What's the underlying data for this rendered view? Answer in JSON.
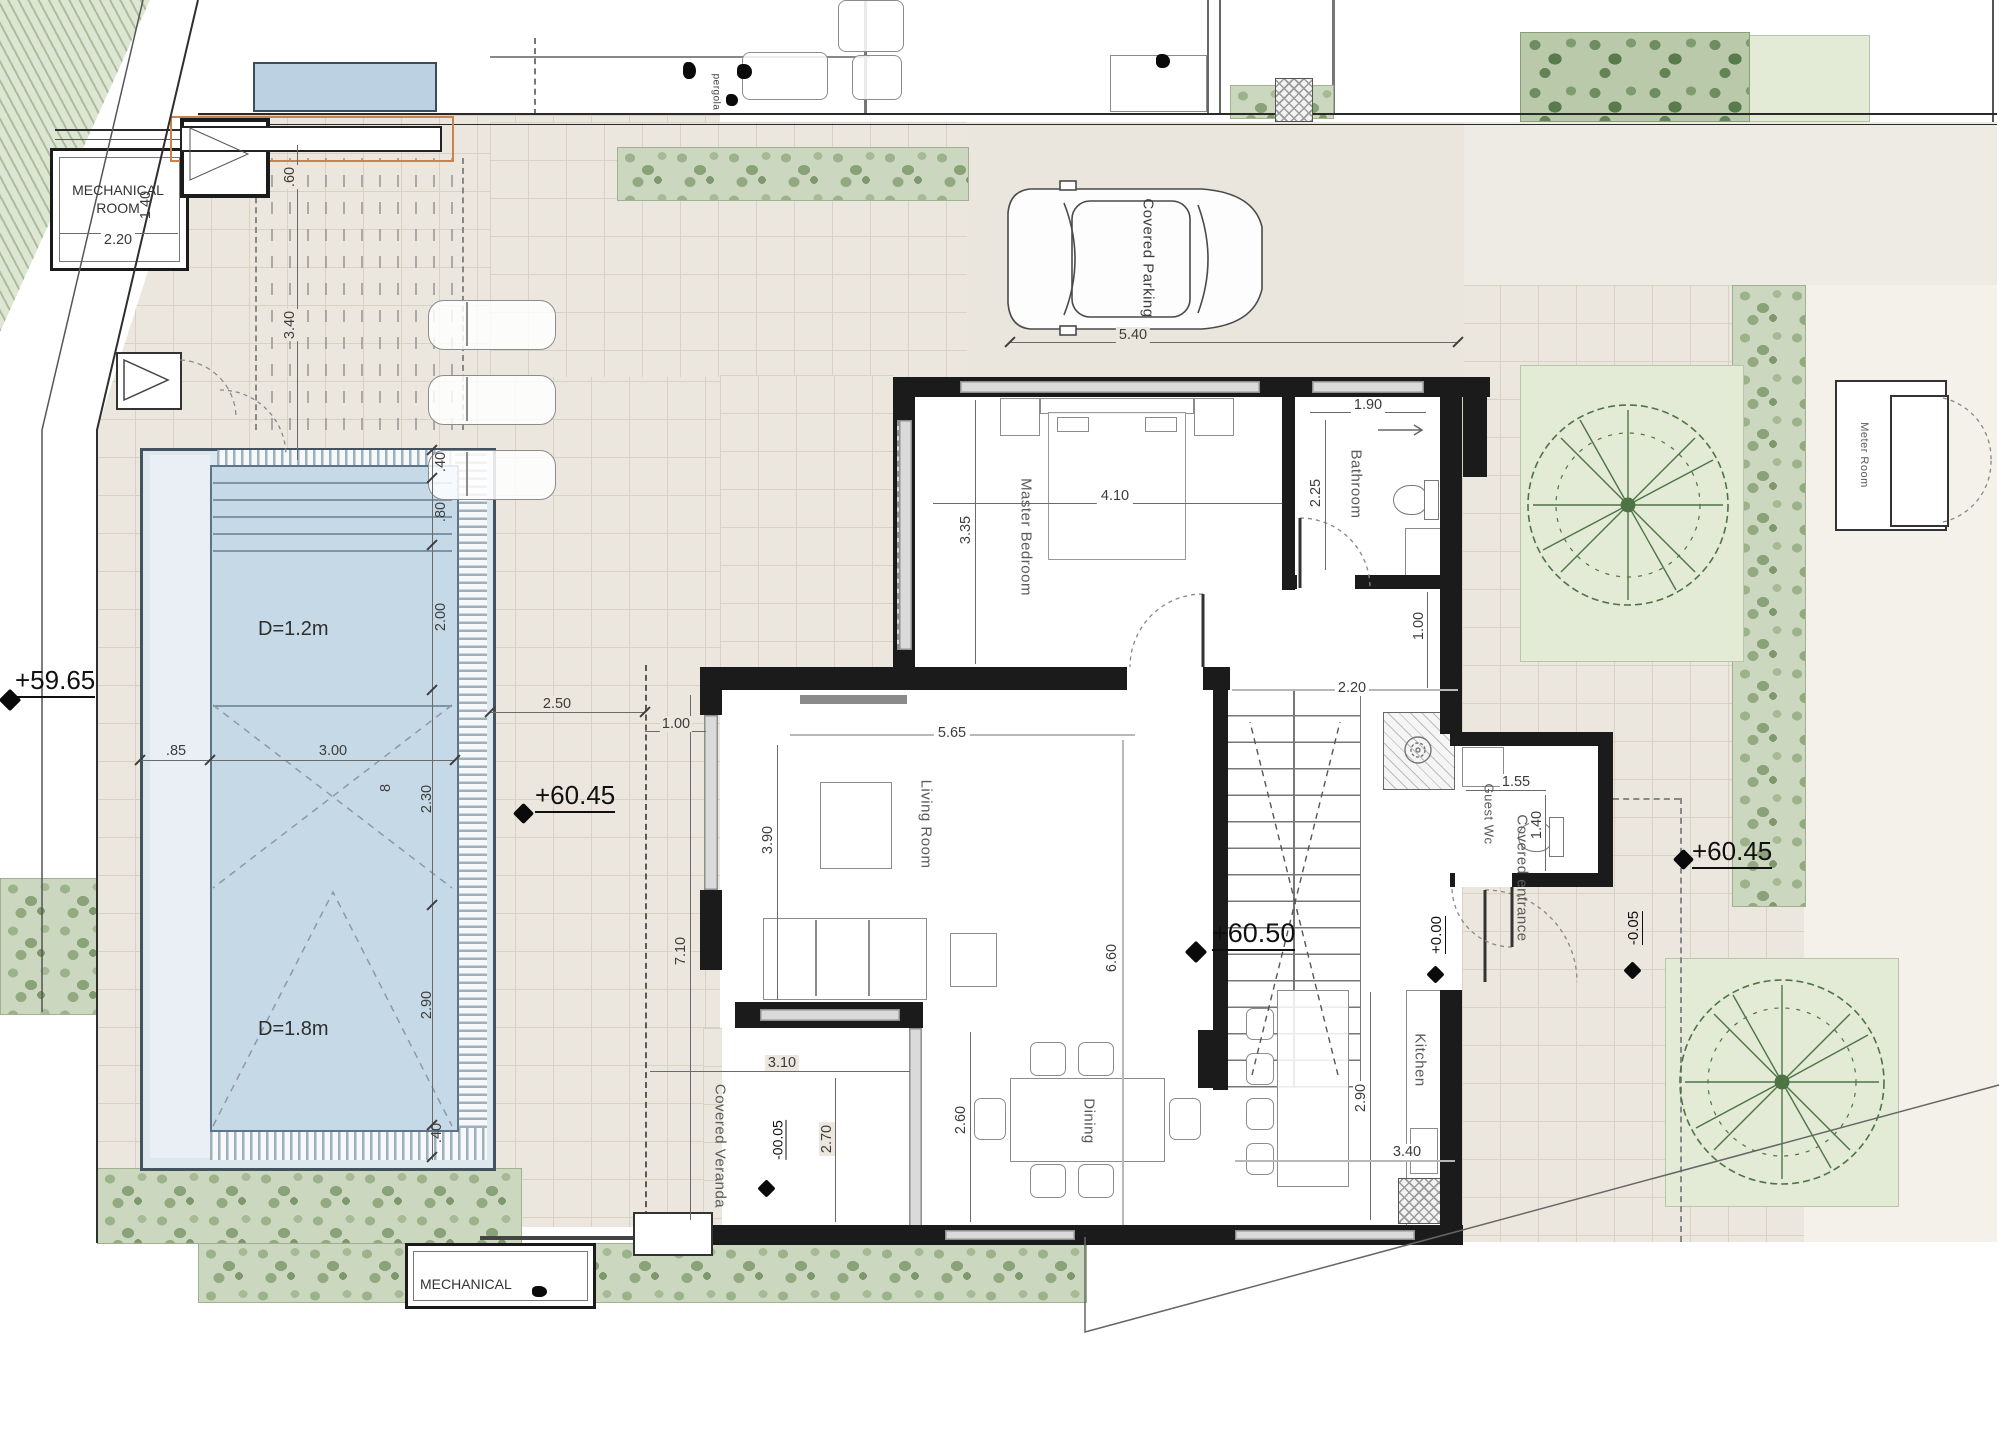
{
  "labels": {
    "mechanical_room": "MECHANICAL ROOM",
    "mechanical": "MECHANICAL",
    "master_bedroom": "Master Bedroom",
    "bathroom": "Bathroom",
    "living_room": "Living Room",
    "guest_wc": "Guest Wc",
    "kitchen": "Kitchen",
    "dining": "Dining",
    "covered_veranda": "Covered Veranda",
    "covered_entrance": "Covered entrance",
    "covered_parking": "Covered Parking",
    "meter_room": "Meter Room",
    "pergola": "pergola",
    "pool_depth_shallow": "D=1.2m",
    "pool_depth_deep": "D=1.8m"
  },
  "levels": {
    "road": "+59.65",
    "terrace_west": "+60.45",
    "interior": "+60.50",
    "terrace_east": "+60.45",
    "entry_zero": "+0.00",
    "entrance_minus": "-0.05",
    "veranda_minus": "-00.05"
  },
  "dims": {
    "mech_width": "2.20",
    "mech_height": "1.40",
    "planter_width": ".60",
    "pergola_length": "3.40",
    "pool_edge_top": ".40",
    "pool_steps": ".80",
    "pool_zone_shallow": "2.00",
    "pool_zone_mid": "2.30",
    "pool_zone_deep": "2.90",
    "pool_edge_bottom": ".40",
    "pool_side": ".85",
    "pool_width": "3.00",
    "pool_length": "8",
    "terrace_gap": "2.50",
    "terrace_walk": "1.00",
    "living_width": "5.65",
    "living_depth": "3.90",
    "living_total": "7.10",
    "bedroom_width": "4.10",
    "bedroom_depth": "3.35",
    "bath_width": "1.90",
    "bath_depth": "2.25",
    "hall_width": "1.00",
    "hall_len": "2.20",
    "parking_width": "5.40",
    "wc_width": "1.55",
    "wc_depth": "1.40",
    "dining_width": "2.60",
    "open_depth": "6.60",
    "kitchen_depth": "2.90",
    "kitchen_width": "3.40",
    "veranda_width": "3.10",
    "veranda_depth": "2.70"
  }
}
